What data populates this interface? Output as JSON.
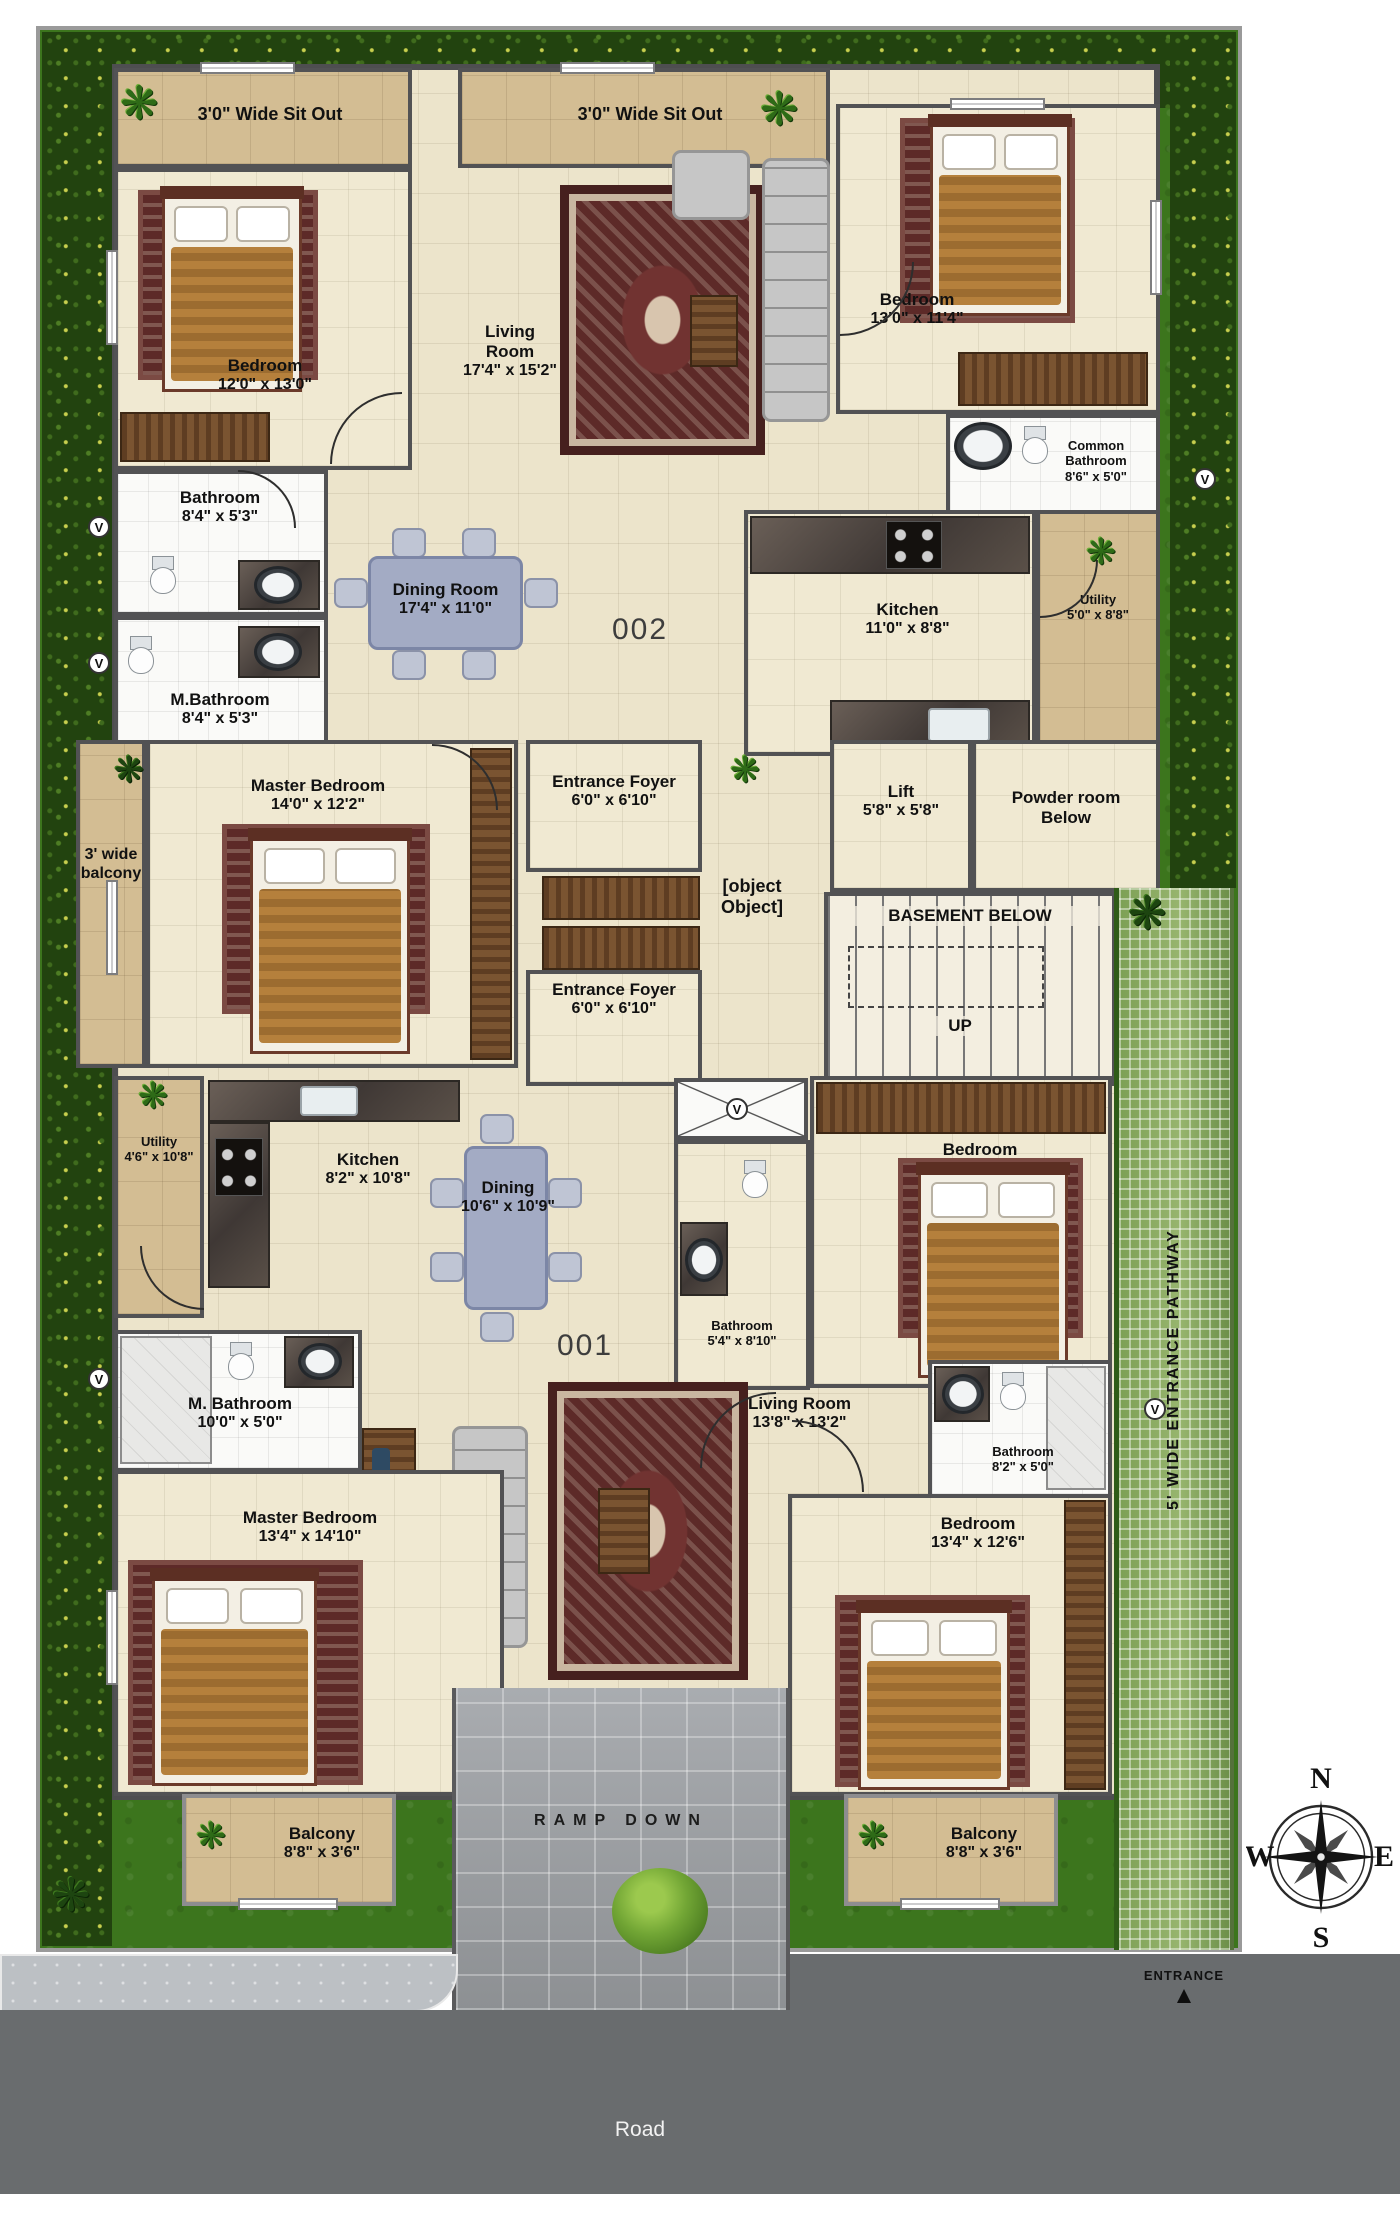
{
  "units": {
    "u002": "002",
    "u001": "001"
  },
  "rooms_002": {
    "sitout_left": {
      "name": "3'0\" Wide Sit Out"
    },
    "sitout_right": {
      "name": "3'0\" Wide Sit Out"
    },
    "living": {
      "name": "Living Room",
      "dims": "17'4\" x 15'2\""
    },
    "bedroom_left": {
      "name": "Bedroom",
      "dims": "12'0\" x 13'0\""
    },
    "bedroom_right": {
      "name": "Bedroom",
      "dims": "13'0\" x 11'4\""
    },
    "common_bathroom": {
      "name": "Common Bathroom",
      "dims": "8'6\" x 5'0\""
    },
    "bathroom": {
      "name": "Bathroom",
      "dims": "8'4\" x 5'3\""
    },
    "m_bathroom": {
      "name": "M.Bathroom",
      "dims": "8'4\" x 5'3\""
    },
    "dining": {
      "name": "Dining Room",
      "dims": "17'4\" x 11'0\""
    },
    "kitchen": {
      "name": "Kitchen",
      "dims": "11'0\" x 8'8\""
    },
    "utility": {
      "name": "Utility",
      "dims": "5'0\" x 8'8\""
    },
    "master_bedroom": {
      "name": "Master Bedroom",
      "dims": "14'0\" x 12'2\""
    },
    "balcony_strip": {
      "name": "3' wide balcony"
    },
    "entrance_foyer": {
      "name": "Entrance Foyer",
      "dims": "6'0\" x 6'10\""
    }
  },
  "rooms_001": {
    "entrance_foyer": {
      "name": "Entrance Foyer",
      "dims": "6'0\" x 6'10\""
    },
    "utility": {
      "name": "Utility",
      "dims": "4'6\" x 10'8\""
    },
    "kitchen": {
      "name": "Kitchen",
      "dims": "8'2\" x 10'8\""
    },
    "dining": {
      "name": "Dining",
      "dims": "10'6\" x 10'9\""
    },
    "bedroom_top": {
      "name": "Bedroom",
      "dims": "12'2\" x 11'4\""
    },
    "bathroom_small": {
      "name": "Bathroom",
      "dims": "5'4\" x 8'10\""
    },
    "m_bathroom": {
      "name": "M. Bathroom",
      "dims": "10'0\" x 5'0\""
    },
    "living": {
      "name": "Living Room",
      "dims": "13'8\" x 13'2\""
    },
    "bathroom_right": {
      "name": "Bathroom",
      "dims": "8'2\" x 5'0\""
    },
    "master_bedroom": {
      "name": "Master Bedroom",
      "dims": "13'4\" x 14'10\""
    },
    "bedroom_right": {
      "name": "Bedroom",
      "dims": "13'4\" x 12'6\""
    },
    "balcony_left": {
      "name": "Balcony",
      "dims": "8'8\" x 3'6\""
    },
    "balcony_right": {
      "name": "Balcony",
      "dims": "8'8\" x 3'6\""
    }
  },
  "core": {
    "lift": {
      "name": "Lift",
      "dims": "5'8\" x 5'8\""
    },
    "powder_room": {
      "name": "Powder room Below"
    },
    "lobby": {
      "name": "6' WIDE LOBBY"
    },
    "basement": {
      "name": "BASEMENT BELOW"
    },
    "up": {
      "name": "UP"
    }
  },
  "site": {
    "ramp": "RAMP DOWN",
    "pathway": "5' WIDE ENTRANCE PATHWAY",
    "entrance": "ENTRANCE",
    "road": "Road"
  },
  "compass": {
    "n": "N",
    "e": "E",
    "s": "S",
    "w": "W"
  },
  "icons": {
    "plant": "❋",
    "entrance_arrow": "▲",
    "vent": "V"
  },
  "colors": {
    "grass": "#3c751d",
    "hedge": "#22430f",
    "pathway": "#86a55e",
    "floor_cream": "#f0e9d2",
    "floor_tan": "#d3bd93",
    "wall": "#525254",
    "wood": "#6a4527",
    "rug": "#5d2a28",
    "table_blue": "#a3abc4",
    "road": "#696c6e",
    "sidewalk": "#bcc0c4"
  }
}
